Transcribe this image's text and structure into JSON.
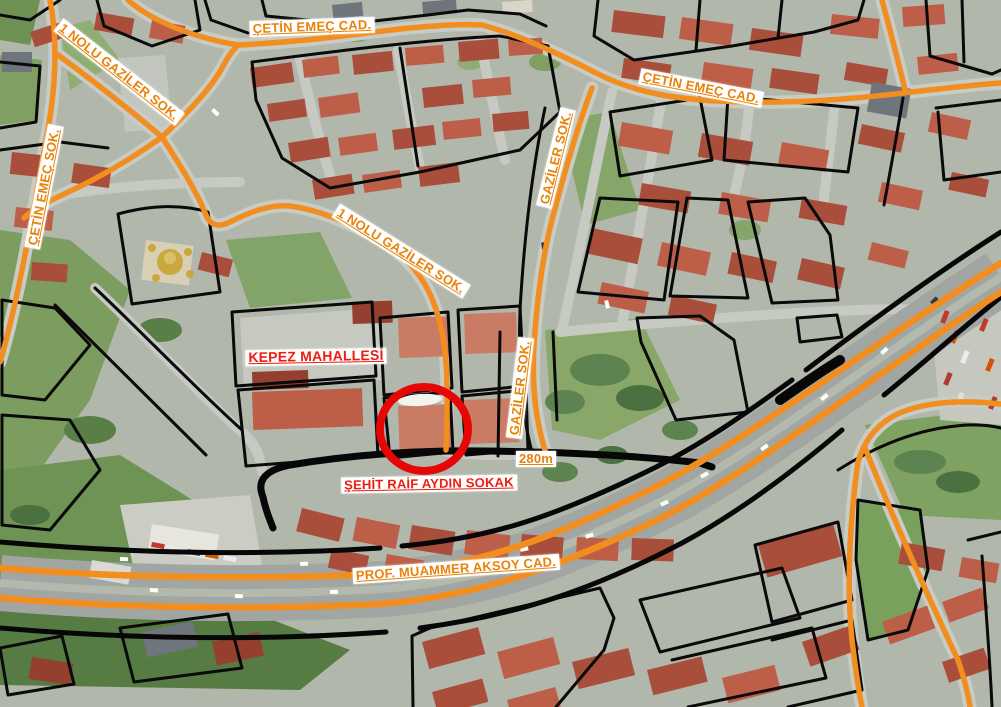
{
  "labels": {
    "cetin_emec_cad_top": "ÇETİN EMEÇ CAD.",
    "gaziler_1_nolu_top_left": "1 NOLU GAZİLER SOK.",
    "cetin_emec_sok_left": "ÇETİN EMEÇ SOK.",
    "gaziler_1_nolu_mid": "1 NOLU GAZİLER SOK.",
    "gaziler_sok_upper": "GAZİLER SOK.",
    "kepez_mahallesi": "KEPEZ MAHALLESİ",
    "gaziler_sok_lower": "GAZİLER SOK.",
    "scale_distance": "280m",
    "sehit_raif_aydin_sokak": "ŞEHİT RAİF AYDIN SOKAK",
    "prof_muammer_aksoy_cad": "PROF. MUAMMER AKSOY CAD.",
    "cetin_emec_cad_right": "ÇETİN EMEÇ CAD."
  },
  "marker": {
    "type": "circle",
    "color": "#e60606"
  },
  "colors": {
    "road_highlight_orange": "#F28D1F",
    "parcel_boundary_black": "#0a0a0a",
    "label_orange": "#E8820A",
    "label_red": "#EE1B10",
    "label_background": "#FFFFFF"
  }
}
